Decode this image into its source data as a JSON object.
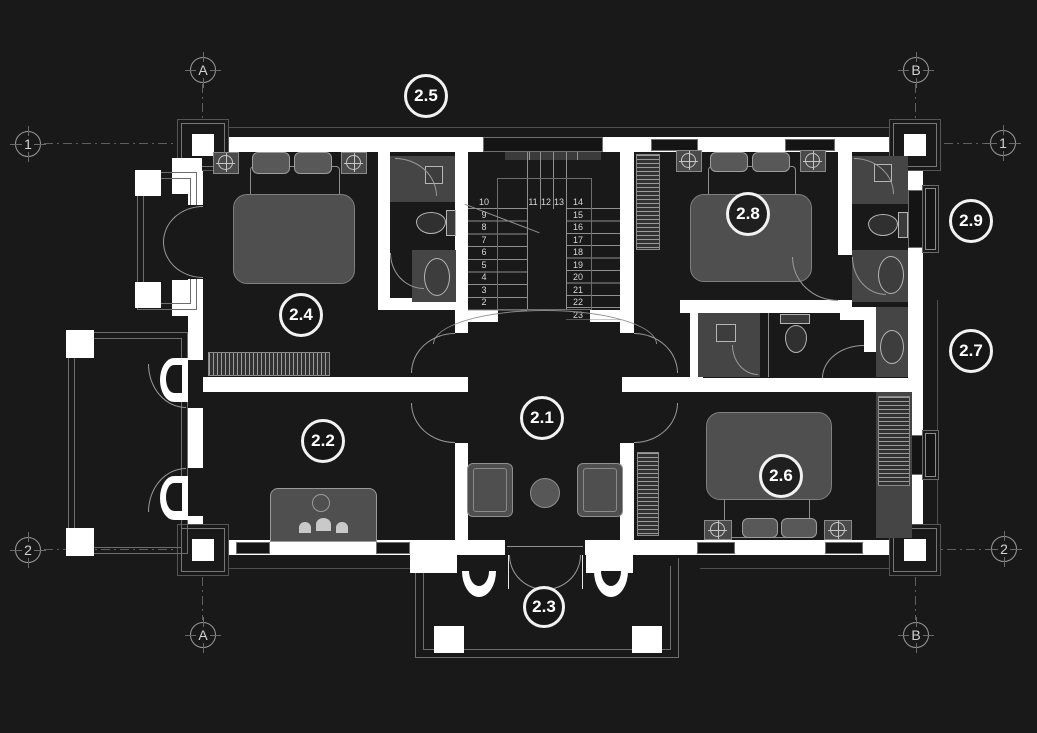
{
  "meta": {
    "bg_color": "#191919",
    "wall_color": "#ffffff",
    "line_color": "#8f8f8f",
    "furniture_color": "#4f4f4f",
    "floor_tile_color": "#454545"
  },
  "grid": {
    "a": "A",
    "b": "B",
    "one": "1",
    "two": "2"
  },
  "rooms": {
    "r21": "2.1",
    "r22": "2.2",
    "r23": "2.3",
    "r24": "2.4",
    "r25": "2.5",
    "r26": "2.6",
    "r27": "2.7",
    "r28": "2.8",
    "r29": "2.9"
  },
  "stairs": {
    "left": [
      "10",
      "9",
      "8",
      "7",
      "6",
      "5",
      "4",
      "3",
      "2"
    ],
    "mid": [
      "11",
      "12",
      "13"
    ],
    "right": [
      "14",
      "15",
      "16",
      "17",
      "18",
      "19",
      "20",
      "21",
      "22",
      "23"
    ]
  }
}
